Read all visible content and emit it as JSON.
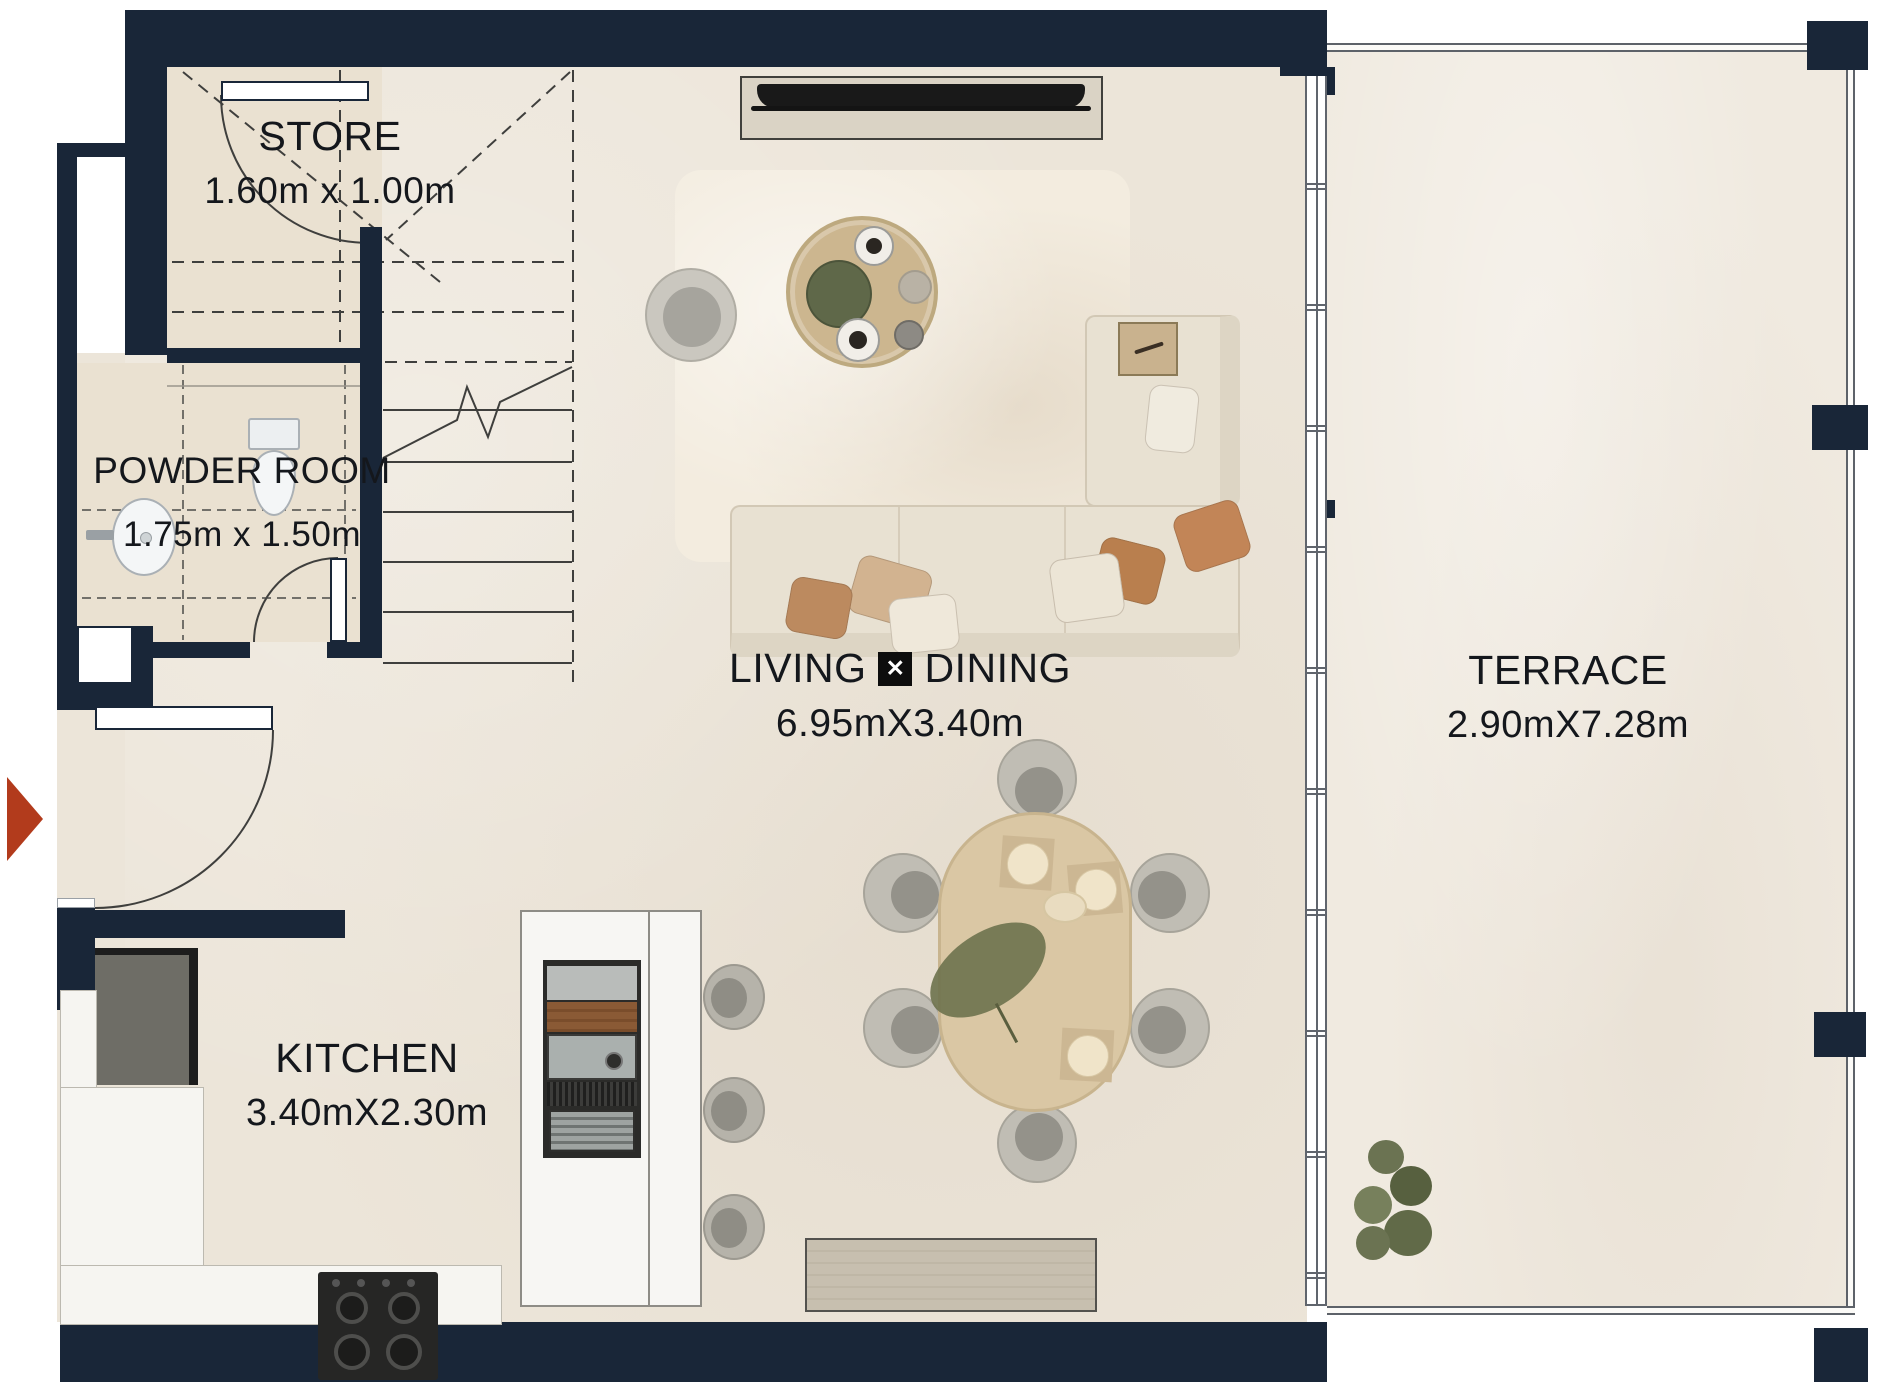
{
  "page": {
    "title": "Floor Plan"
  },
  "rooms": {
    "store": {
      "label": "STORE",
      "dims": "1.60m x 1.00m"
    },
    "powder_room": {
      "label": "POWDER ROOM",
      "dims": "1.75m x 1.50m"
    },
    "living_dining": {
      "label_left": "LIVING",
      "separator_glyph": "✕",
      "label_right": "DINING",
      "dims": "6.95mX3.40m"
    },
    "kitchen": {
      "label": "KITCHEN",
      "dims": "3.40mX2.30m"
    },
    "terrace": {
      "label": "TERRACE",
      "dims": "2.90mX7.28m"
    }
  },
  "markers": {
    "entry_arrow_icon": "entry-arrow-icon",
    "shaft_x_icon": "shaft-x-icon",
    "stair_break_icon": "stair-break-line"
  },
  "colors": {
    "wall": "#192638",
    "floor": "#ece5d9",
    "room_floor": "#eae1d1",
    "terrace_floor": "#f0eae0",
    "kitchen_marble": "#f6f5f1",
    "accent_red": "#b23b1c",
    "label_text": "#14171c"
  }
}
